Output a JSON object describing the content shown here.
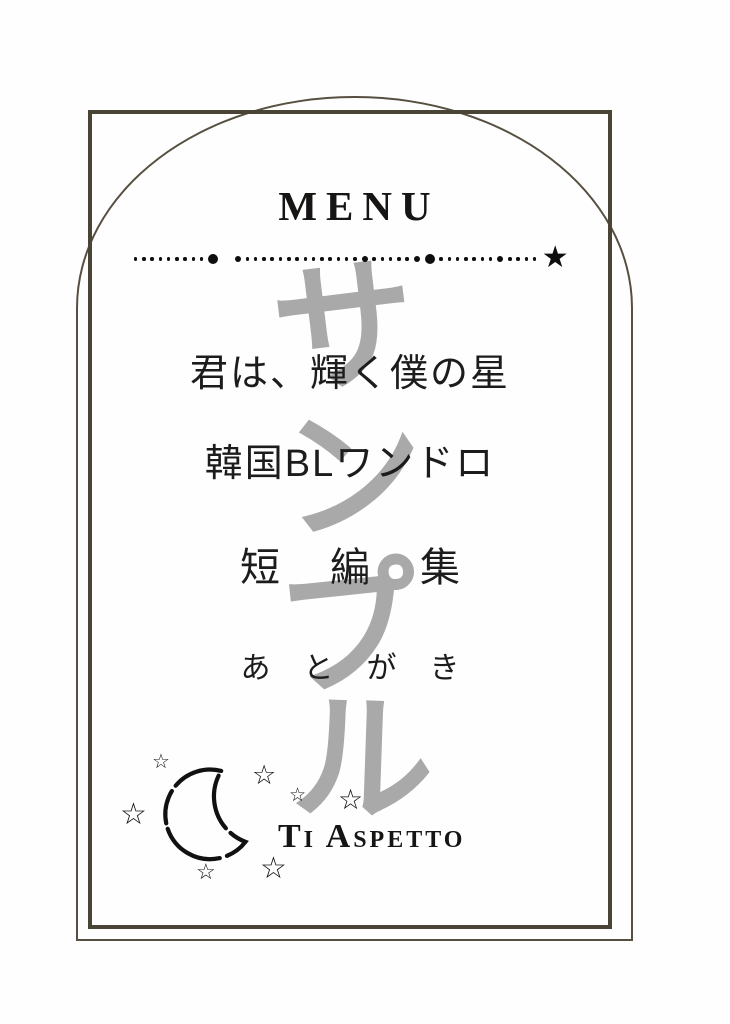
{
  "header": {
    "title": "MENU"
  },
  "divider": {
    "pattern": [
      "s",
      "s",
      "s",
      "s",
      "s",
      "s",
      "s",
      "s",
      "s",
      "l",
      "gap",
      "m",
      "s",
      "s",
      "s",
      "s",
      "s",
      "s",
      "s",
      "s",
      "s",
      "s",
      "s",
      "s",
      "s",
      "s",
      "m",
      "s",
      "s",
      "s",
      "s",
      "s",
      "m",
      "l",
      "s",
      "s",
      "s",
      "s",
      "s",
      "s",
      "s",
      "m",
      "s",
      "s",
      "s",
      "s"
    ],
    "star": "★"
  },
  "watermark": {
    "text": "サンプル",
    "chars": [
      "サ",
      "ン",
      "プ",
      "ル"
    ],
    "color": "#a9a9a9"
  },
  "menu": {
    "items": [
      {
        "label": "君は、輝く僕の星"
      },
      {
        "label": "韓国BLワンドロ"
      },
      {
        "label": "短編集"
      },
      {
        "label": "あとがき"
      }
    ]
  },
  "footer": {
    "text": "Ti Aspetto"
  },
  "decor": {
    "star_char": "☆",
    "moon": "crescent-moon",
    "stars": [
      {
        "x": 152,
        "y": 752,
        "size": 20
      },
      {
        "x": 252,
        "y": 762,
        "size": 27
      },
      {
        "x": 120,
        "y": 800,
        "size": 30
      },
      {
        "x": 289,
        "y": 786,
        "size": 19
      },
      {
        "x": 338,
        "y": 786,
        "size": 28
      },
      {
        "x": 196,
        "y": 861,
        "size": 22
      },
      {
        "x": 260,
        "y": 854,
        "size": 30
      }
    ]
  },
  "colors": {
    "frame": "#4a4437",
    "arch": "#575040",
    "text": "#1c1c1c",
    "watermark": "#a9a9a9",
    "background": "#fefefe"
  }
}
